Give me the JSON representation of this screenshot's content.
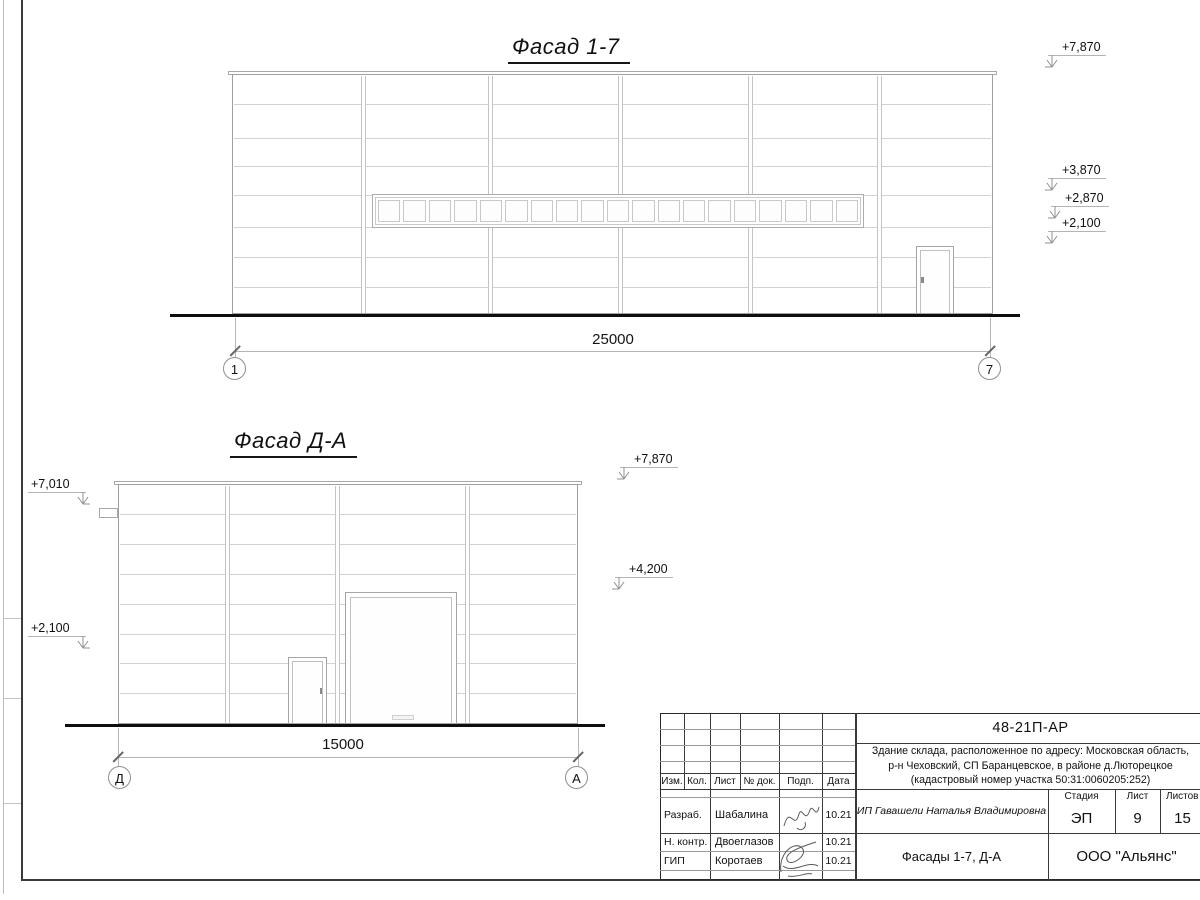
{
  "facade_top": {
    "title": "Фасад 1-7",
    "dimension": "25000",
    "axis_left": "1",
    "axis_right": "7",
    "window_pane_count": 19,
    "elevations_right": [
      "+7,870",
      "+3,870",
      "+2,870",
      "+2,100"
    ]
  },
  "facade_side": {
    "title": "Фасад Д-А",
    "dimension": "15000",
    "axis_left": "Д",
    "axis_right": "А",
    "elevations_left": [
      "+7,010",
      "+2,100"
    ],
    "elevations_right": [
      "+7,870",
      "+4,200"
    ]
  },
  "title_block": {
    "doc_number": "48-21П-АР",
    "project_description": [
      "Здание склада, расположенное по адресу: Московская область,",
      "р-н Чеховский, СП Баранцевское, в районе д.Люторецкое",
      "(кадастровый номер участка 50:31:0060205:252)"
    ],
    "columns": [
      "Изм.",
      "Кол.",
      "Лист",
      "№ док.",
      "Подп.",
      "Дата"
    ],
    "personnel": [
      {
        "role": "Разраб.",
        "name": "Шабалина",
        "date": "10.21"
      },
      {
        "role": "Н. контр.",
        "name": "Двоеглазов",
        "date": "10.21"
      },
      {
        "role": "ГИП",
        "name": "Коротаев",
        "date": "10.21"
      }
    ],
    "client": "ИП Гавашели Наталья Владимировна",
    "stage_label": "Стадия",
    "sheet_label": "Лист",
    "sheets_label": "Листов",
    "stage": "ЭП",
    "sheet_number": "9",
    "sheet_count": "15",
    "sheet_title": "Фасады 1-7, Д-А",
    "company": "ООО \"Альянс\""
  }
}
